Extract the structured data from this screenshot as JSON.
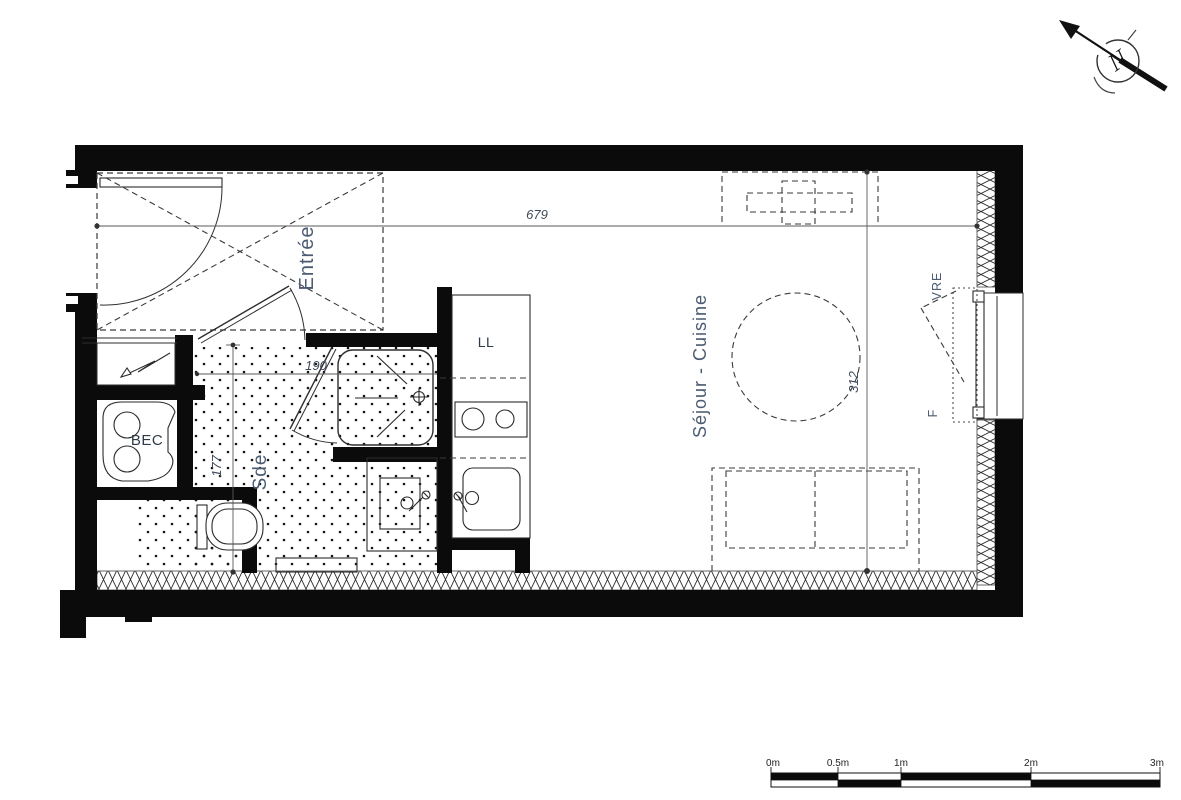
{
  "plan": {
    "rooms": {
      "entree_label": "Entrée",
      "sejour_cuisine_label": "Séjour - Cuisine",
      "sde_label": "Sde",
      "bec_label": "BEC"
    },
    "appliances": {
      "washing_machine_label": "LL"
    },
    "window": {
      "shutter_label": "VRE",
      "window_label": "F"
    },
    "dimensions": {
      "total_width": "679",
      "sejour_depth": "312",
      "sde_width": "190",
      "sde_depth": "177"
    },
    "north_label": "N"
  },
  "scale_bar": {
    "labels": [
      "0m",
      "0.5m",
      "1m",
      "2m",
      "3m"
    ]
  },
  "colors": {
    "wall": "#0b0b0b",
    "room_label": "#4a5b72",
    "dimension_label": "#3e4a5a",
    "background": "#ffffff"
  }
}
